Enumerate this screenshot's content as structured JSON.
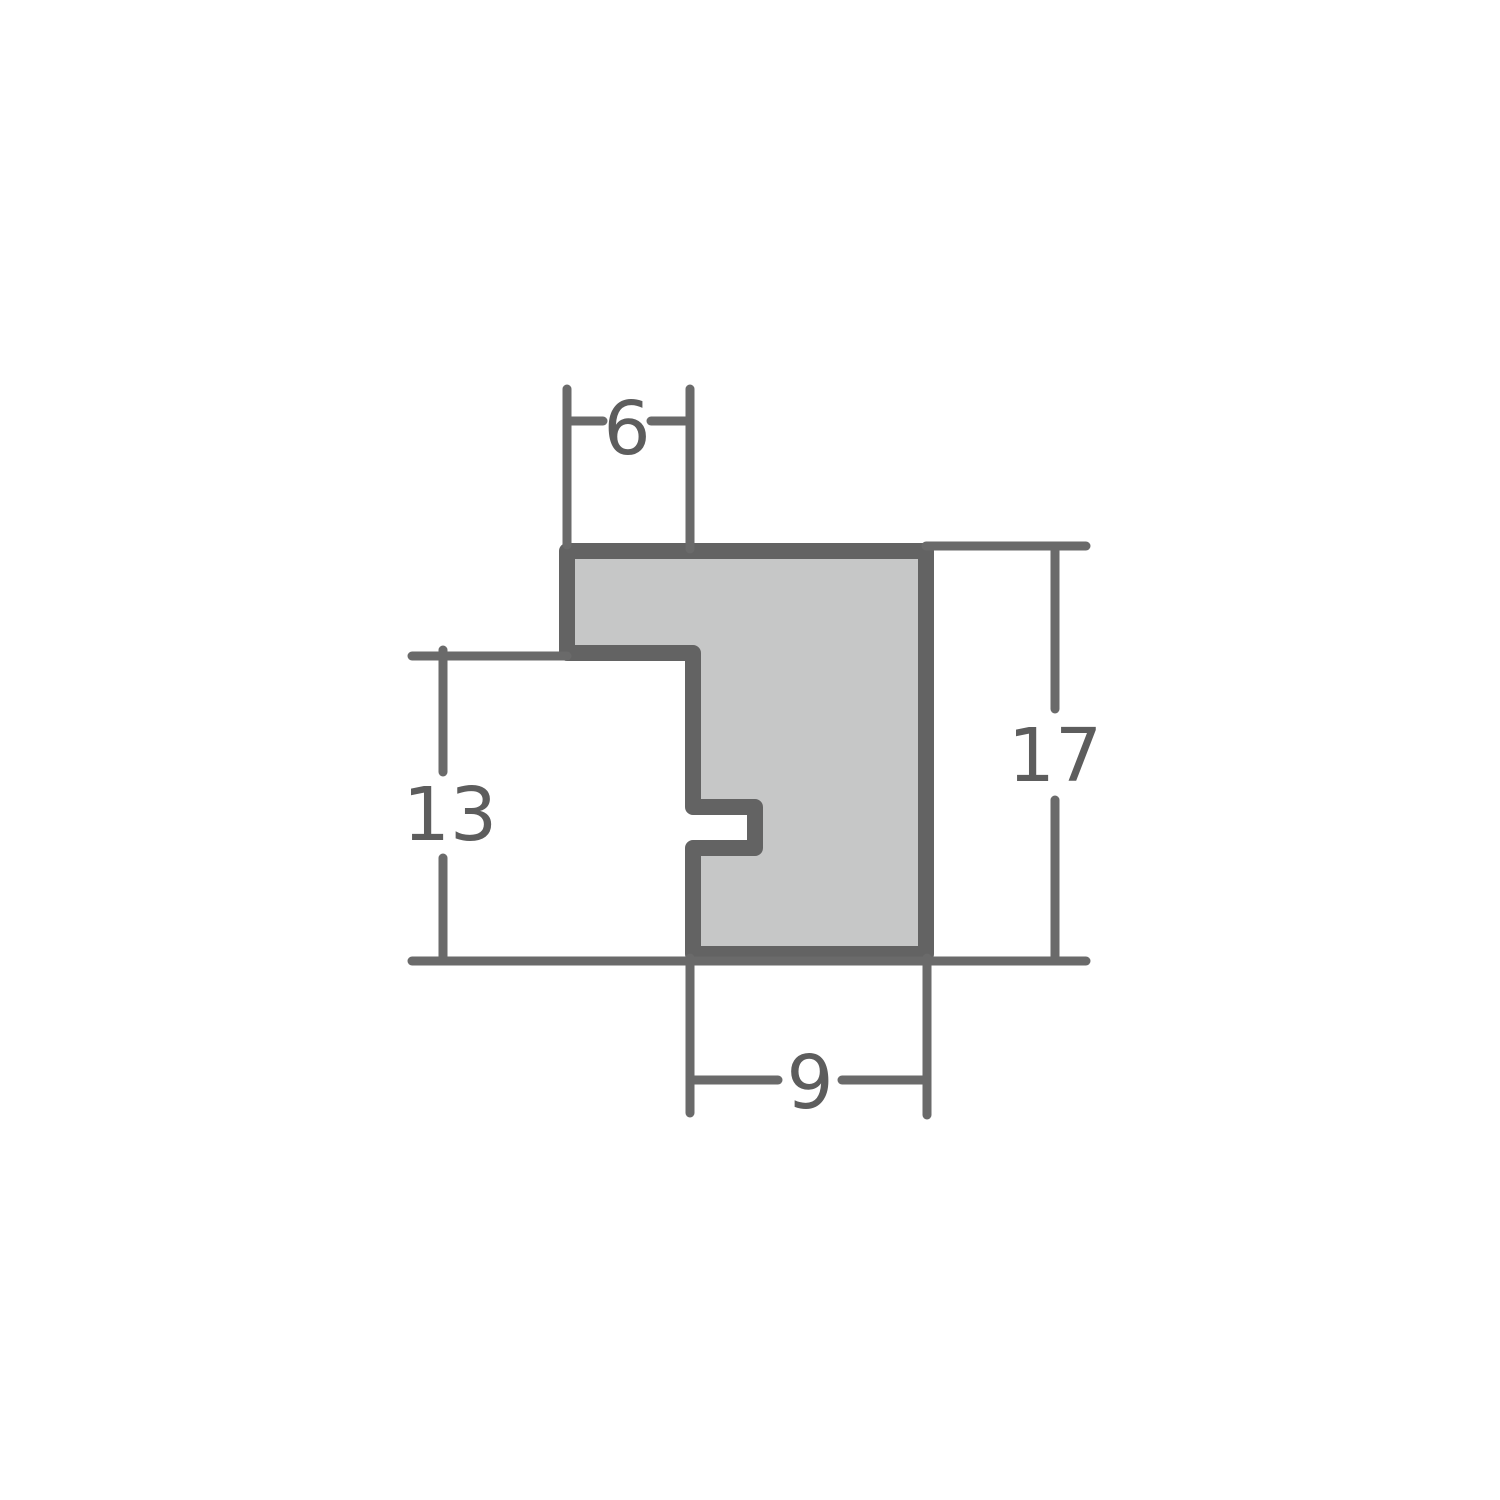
{
  "diagram": {
    "name": "frame-moulding-profile-cross-section",
    "type": "technical-dimension-drawing",
    "dimensions": {
      "top_width": {
        "value": "6",
        "orientation": "horizontal",
        "position": "top"
      },
      "left_height": {
        "value": "13",
        "orientation": "vertical",
        "position": "left"
      },
      "right_height": {
        "value": "17",
        "orientation": "vertical",
        "position": "right"
      },
      "bottom_width": {
        "value": "9",
        "orientation": "horizontal",
        "position": "bottom"
      }
    },
    "colors": {
      "background": "#ffffff",
      "profile_fill": "#c6c7c7",
      "profile_outline": "#636363",
      "dimension_line": "#6a6a6a",
      "label_text": "#5d5d5d"
    }
  }
}
